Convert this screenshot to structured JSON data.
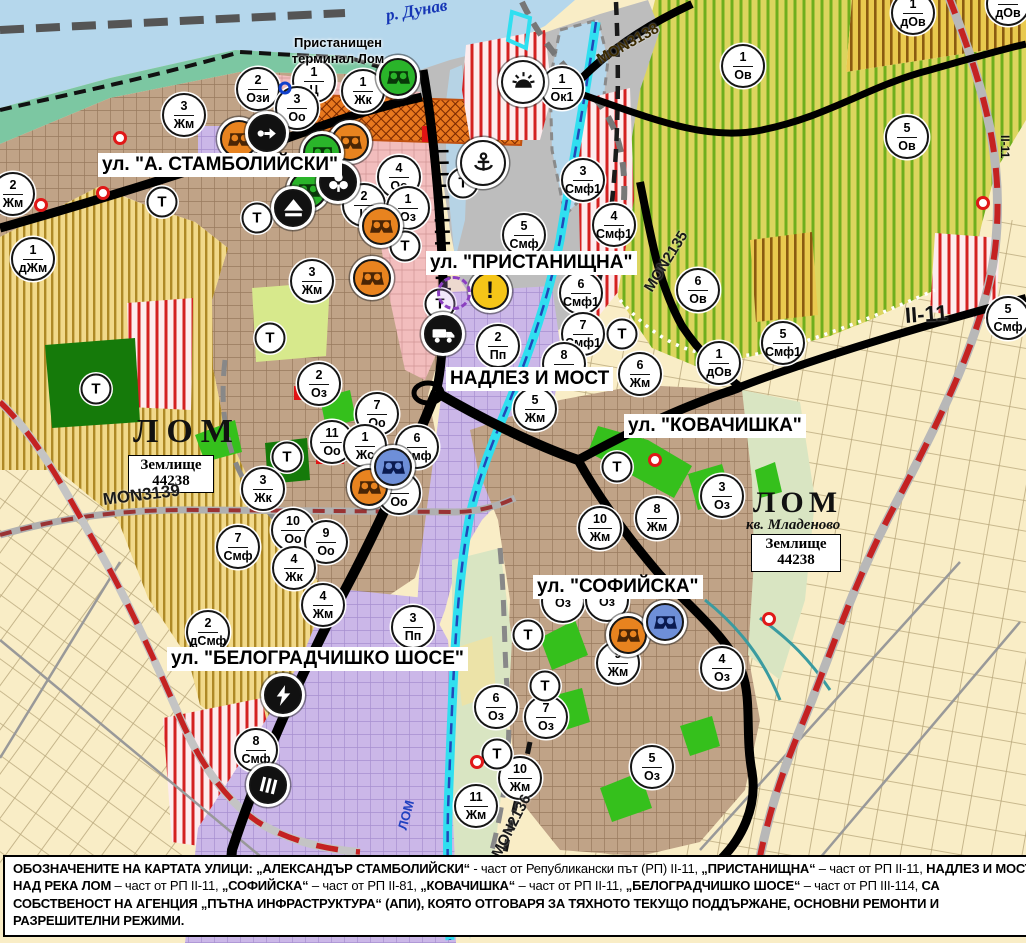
{
  "colors": {
    "water": "#b5d7ec",
    "shore_teal": "#7cc7a2",
    "urban_brown": "#c0a387",
    "pink": "#f2bdbd",
    "purple": "#cbb7e8",
    "gray_port": "#bdbdbd",
    "cream": "#f9edc6",
    "yellow_ag": "#f1d98a",
    "yellow_stripe": "#a27c14",
    "vine_base": "#dcd55e",
    "vine_stripe": "#6fae1d",
    "brown_base": "#e9c94e",
    "brown_stripe": "#8a5a10",
    "red_stripe": "#d42020",
    "green_bright": "#35c01c",
    "green_dark": "#157a0a",
    "green_light": "#d7e98c",
    "valley": "#d9e5c2",
    "rail_red": "#c42222",
    "river_cyan": "#30dff0",
    "river_blue": "#2248b8",
    "label_blue": "#1535b5"
  },
  "map": {
    "port_label": {
      "line1": "Пристанищен",
      "line2": "терминал Лом"
    },
    "river_labels": {
      "danube": {
        "text": "р. Дунав"
      },
      "lom": {
        "text": "ЛОМ"
      }
    },
    "area_labels": {
      "lom_main": {
        "text": "ЛОМ"
      },
      "lom_mladenovo": {
        "text": "ЛОМ"
      },
      "kvartal": {
        "text": "кв. Младеново"
      }
    },
    "landplots": [
      {
        "line1": "Землище",
        "line2": "44238"
      },
      {
        "line1": "Землище",
        "line2": "44238"
      }
    ],
    "street_labels": [
      {
        "text": "ул. \"А. СТАМБОЛИЙСКИ\"",
        "x": 98,
        "y": 153
      },
      {
        "text": "ул. \"ПРИСТАНИЩНА\"",
        "x": 426,
        "y": 251
      },
      {
        "text": "НАДЛЕЗ И МОСТ",
        "x": 446,
        "y": 367
      },
      {
        "text": "ул. \"КОВАЧИШКА\"",
        "x": 624,
        "y": 414
      },
      {
        "text": "ул. \"СОФИЙСКА\"",
        "x": 533,
        "y": 575
      },
      {
        "text": "ул. \"БЕЛОГРАДЧИШКО ШОСЕ\"",
        "x": 167,
        "y": 647
      }
    ],
    "road_labels": [
      {
        "text": "MON3139",
        "x": 103,
        "y": 490,
        "rot": -7,
        "size": 17,
        "color": "#1a1a1a"
      },
      {
        "text": "MON3138",
        "x": 598,
        "y": 52,
        "rot": -29,
        "size": 15,
        "color": "#3a2a00"
      },
      {
        "text": "MON2135",
        "x": 648,
        "y": 282,
        "rot": -58,
        "size": 15,
        "color": "#1a1a1a"
      },
      {
        "text": "MON2136",
        "x": 496,
        "y": 848,
        "rot": -63,
        "size": 15,
        "color": "#1a1a1a"
      },
      {
        "text": "II-11",
        "x": 905,
        "y": 303,
        "rot": -4,
        "size": 22,
        "color": "#111111"
      },
      {
        "text": "II-11",
        "x": 1005,
        "y": 128,
        "rot": 90,
        "size": 12,
        "color": "#111111"
      }
    ],
    "t_label": "Т",
    "zone_markers": [
      {
        "n": "2",
        "a": "Ози",
        "x": 258,
        "y": 89
      },
      {
        "n": "1",
        "a": "Ц",
        "x": 314,
        "y": 81
      },
      {
        "n": "3",
        "a": "Оо",
        "x": 297,
        "y": 108
      },
      {
        "n": "1",
        "a": "Жк",
        "x": 363,
        "y": 91
      },
      {
        "n": "1",
        "a": "Ок1",
        "x": 562,
        "y": 88
      },
      {
        "n": "1",
        "a": "Ов",
        "x": 743,
        "y": 66
      },
      {
        "n": "1",
        "a": "дОв",
        "x": 913,
        "y": 13
      },
      {
        "n": "1",
        "a": "дОв",
        "x": 1008,
        "y": 4
      },
      {
        "n": "3",
        "a": "Жм",
        "x": 184,
        "y": 115
      },
      {
        "n": "2",
        "a": "Жм",
        "x": 13,
        "y": 194
      },
      {
        "n": "1",
        "a": "дЖм",
        "x": 33,
        "y": 259
      },
      {
        "n": "3",
        "a": "Жм",
        "x": 312,
        "y": 281
      },
      {
        "n": "5",
        "a": "Ов",
        "x": 907,
        "y": 137
      },
      {
        "n": "3",
        "a": "Смф1",
        "x": 583,
        "y": 180
      },
      {
        "n": "4",
        "a": "Смф1",
        "x": 614,
        "y": 225
      },
      {
        "n": "6",
        "a": "Ов",
        "x": 698,
        "y": 290
      },
      {
        "n": "1",
        "a": "дОв",
        "x": 719,
        "y": 363
      },
      {
        "n": "5",
        "a": "Смф1",
        "x": 783,
        "y": 343
      },
      {
        "n": "6",
        "a": "Жм",
        "x": 640,
        "y": 374
      },
      {
        "n": "4",
        "a": "Оо",
        "x": 399,
        "y": 177
      },
      {
        "n": "2",
        "a": "Ц",
        "x": 364,
        "y": 205
      },
      {
        "n": "1",
        "a": "Оз",
        "x": 408,
        "y": 208
      },
      {
        "n": "5",
        "a": "Смф",
        "x": 524,
        "y": 235
      },
      {
        "n": "6",
        "a": "Смф1",
        "x": 581,
        "y": 293
      },
      {
        "n": "7",
        "a": "Смф1",
        "x": 583,
        "y": 334
      },
      {
        "n": "2",
        "a": "Пп",
        "x": 498,
        "y": 346
      },
      {
        "n": "8",
        "a": "Жм",
        "x": 564,
        "y": 364
      },
      {
        "n": "5",
        "a": "Жм",
        "x": 535,
        "y": 409
      },
      {
        "n": "2",
        "a": "Оз",
        "x": 319,
        "y": 384
      },
      {
        "n": "7",
        "a": "Оо",
        "x": 377,
        "y": 414
      },
      {
        "n": "11",
        "a": "Оо",
        "x": 332,
        "y": 442
      },
      {
        "n": "1",
        "a": "Жс",
        "x": 365,
        "y": 446
      },
      {
        "n": "6",
        "a": "Смф",
        "x": 417,
        "y": 447
      },
      {
        "n": "3",
        "a": "Жк",
        "x": 263,
        "y": 489
      },
      {
        "n": "8",
        "a": "Оо",
        "x": 399,
        "y": 493
      },
      {
        "n": "10",
        "a": "Оо",
        "x": 293,
        "y": 530
      },
      {
        "n": "9",
        "a": "Оо",
        "x": 326,
        "y": 542
      },
      {
        "n": "7",
        "a": "Смф",
        "x": 238,
        "y": 547
      },
      {
        "n": "4",
        "a": "Жк",
        "x": 294,
        "y": 568
      },
      {
        "n": "3",
        "a": "Оз",
        "x": 722,
        "y": 496
      },
      {
        "n": "8",
        "a": "Жм",
        "x": 657,
        "y": 518
      },
      {
        "n": "10",
        "a": "Жм",
        "x": 600,
        "y": 528
      },
      {
        "n": "",
        "a": "Оз",
        "x": 563,
        "y": 601
      },
      {
        "n": "",
        "a": "Оз",
        "x": 607,
        "y": 600
      },
      {
        "n": "9",
        "a": "Жм",
        "x": 618,
        "y": 663
      },
      {
        "n": "4",
        "a": "Оз",
        "x": 722,
        "y": 668
      },
      {
        "n": "6",
        "a": "Оз",
        "x": 496,
        "y": 707
      },
      {
        "n": "7",
        "a": "Оз",
        "x": 546,
        "y": 717
      },
      {
        "n": "10",
        "a": "Жм",
        "x": 520,
        "y": 778
      },
      {
        "n": "5",
        "a": "Оз",
        "x": 652,
        "y": 767
      },
      {
        "n": "11",
        "a": "Жм",
        "x": 476,
        "y": 806
      },
      {
        "n": "2",
        "a": "дСмф",
        "x": 208,
        "y": 632
      },
      {
        "n": "4",
        "a": "Жм",
        "x": 323,
        "y": 605
      },
      {
        "n": "3",
        "a": "Пп",
        "x": 413,
        "y": 627
      },
      {
        "n": "8",
        "a": "Смф",
        "x": 256,
        "y": 750
      },
      {
        "n": "5",
        "a": "Смф",
        "x": 1008,
        "y": 318
      }
    ],
    "t_markers": [
      {
        "x": 162,
        "y": 202
      },
      {
        "x": 257,
        "y": 218
      },
      {
        "x": 463,
        "y": 183
      },
      {
        "x": 405,
        "y": 246
      },
      {
        "x": 440,
        "y": 304
      },
      {
        "x": 622,
        "y": 334
      },
      {
        "x": 270,
        "y": 338
      },
      {
        "x": 287,
        "y": 457
      },
      {
        "x": 96,
        "y": 389
      },
      {
        "x": 617,
        "y": 467
      },
      {
        "x": 528,
        "y": 635
      },
      {
        "x": 545,
        "y": 686
      },
      {
        "x": 497,
        "y": 754
      }
    ],
    "icon_markers": [
      {
        "type": "binoculars",
        "x": 239,
        "y": 139,
        "bg": "#e8831f",
        "fg": "#4a2505"
      },
      {
        "type": "binoculars",
        "x": 350,
        "y": 142,
        "bg": "#e8831f",
        "fg": "#4a2505"
      },
      {
        "type": "binoculars",
        "x": 381,
        "y": 226,
        "bg": "#e8831f",
        "fg": "#4a2505"
      },
      {
        "type": "binoculars",
        "x": 372,
        "y": 278,
        "bg": "#e8831f",
        "fg": "#4a2505"
      },
      {
        "type": "binoculars",
        "x": 369,
        "y": 487,
        "bg": "#e8831f",
        "fg": "#4a2505"
      },
      {
        "type": "binoculars",
        "x": 628,
        "y": 635,
        "bg": "#e8831f",
        "fg": "#4a2505"
      },
      {
        "type": "binoculars",
        "x": 398,
        "y": 77,
        "bg": "#2ab42a",
        "fg": "#083808"
      },
      {
        "type": "binoculars",
        "x": 322,
        "y": 153,
        "bg": "#2ab42a",
        "fg": "#083808"
      },
      {
        "type": "binoculars",
        "x": 308,
        "y": 190,
        "bg": "#2ab42a",
        "fg": "#083808"
      },
      {
        "type": "binoculars",
        "x": 393,
        "y": 467,
        "bg": "#6e8fd8",
        "fg": "#0a1a50"
      },
      {
        "type": "binoculars",
        "x": 665,
        "y": 622,
        "bg": "#6e8fd8",
        "fg": "#0a1a50"
      },
      {
        "type": "arrow",
        "x": 267,
        "y": 133,
        "bg": "#111111",
        "fg": "#ffffff"
      },
      {
        "type": "trefoil",
        "x": 338,
        "y": 182,
        "bg": "#111111",
        "fg": "#ffffff"
      },
      {
        "type": "mountain",
        "x": 293,
        "y": 208,
        "bg": "#111111",
        "fg": "#ffffff"
      },
      {
        "type": "truck",
        "x": 443,
        "y": 334,
        "bg": "#111111",
        "fg": "#ffffff"
      },
      {
        "type": "anchor",
        "x": 483,
        "y": 163,
        "bg": "#ffffff",
        "fg": "#111111",
        "d": 46
      },
      {
        "type": "sun",
        "x": 523,
        "y": 82,
        "bg": "#ffffff",
        "fg": "#111111",
        "d": 44
      },
      {
        "type": "exclaim",
        "x": 490,
        "y": 291,
        "bg": "#f5c518",
        "fg": "#111111",
        "glyph": "!"
      },
      {
        "type": "bolt",
        "x": 283,
        "y": 695,
        "bg": "#111111",
        "fg": "#ffffff"
      },
      {
        "type": "bars",
        "x": 268,
        "y": 785,
        "bg": "#111111",
        "fg": "#ffffff"
      }
    ],
    "ring_markers": [
      {
        "x": 454,
        "y": 293,
        "d": 34,
        "style": "dashed",
        "color": "#8b3fc0",
        "bg": "rgba(205,160,235,0.25)",
        "w": 3
      },
      {
        "x": 285,
        "y": 88,
        "d": 13,
        "style": "solid",
        "color": "#1040cc",
        "bg": "transparent",
        "w": 3
      },
      {
        "x": 120,
        "y": 138,
        "d": 14,
        "style": "solid",
        "color": "#e01818",
        "bg": "#ffffff",
        "w": 3.5
      },
      {
        "x": 103,
        "y": 193,
        "d": 14,
        "style": "solid",
        "color": "#e01818",
        "bg": "#ffffff",
        "w": 3.5
      },
      {
        "x": 41,
        "y": 205,
        "d": 14,
        "style": "solid",
        "color": "#e01818",
        "bg": "#ffffff",
        "w": 3.5
      },
      {
        "x": 655,
        "y": 460,
        "d": 14,
        "style": "solid",
        "color": "#e01818",
        "bg": "#ffffff",
        "w": 3.5
      },
      {
        "x": 769,
        "y": 619,
        "d": 14,
        "style": "solid",
        "color": "#e01818",
        "bg": "#ffffff",
        "w": 3.5
      },
      {
        "x": 983,
        "y": 203,
        "d": 14,
        "style": "solid",
        "color": "#e01818",
        "bg": "#ffffff",
        "w": 3.5
      },
      {
        "x": 477,
        "y": 762,
        "d": 14,
        "style": "solid",
        "color": "#e01818",
        "bg": "#ffffff",
        "w": 3.5
      }
    ]
  },
  "footer": {
    "segments": [
      {
        "bold": true,
        "text": "ОБОЗНАЧЕНИТЕ НА КАРТАТА УЛИЦИ: „АЛЕКСАНДЪР СТАМБОЛИЙСКИ“"
      },
      {
        "bold": false,
        "text": " - част от Републикански път (РП) II-11, "
      },
      {
        "bold": true,
        "text": "„ПРИСТАНИЩНА“"
      },
      {
        "bold": false,
        "text": " – част от РП II-11, "
      },
      {
        "bold": true,
        "text": "НАДЛЕЗ И МОСТ НАД РЕКА ЛОМ"
      },
      {
        "bold": false,
        "text": " – част от РП II-11, "
      },
      {
        "bold": true,
        "text": "„СОФИЙСКА“"
      },
      {
        "bold": false,
        "text": " – част от РП II-81, "
      },
      {
        "bold": true,
        "text": "„КОВАЧИШКА“"
      },
      {
        "bold": false,
        "text": " – част от РП II-11, "
      },
      {
        "bold": true,
        "text": "„БЕЛОГРАДЧИШКО ШОСЕ“"
      },
      {
        "bold": false,
        "text": " – част от РП III-114, "
      },
      {
        "bold": true,
        "text": "СА СОБСТВЕНОСТ НА АГЕНЦИЯ „ПЪТНА ИНФРАСТРУКТУРА“ (АПИ), КОЯТО ОТГОВАРЯ ЗА ТЯХНОТО ТЕКУЩО ПОДДЪРЖАНЕ, ОСНОВНИ РЕМОНТИ И РАЗРЕШИТЕЛНИ РЕЖИМИ."
      }
    ]
  }
}
